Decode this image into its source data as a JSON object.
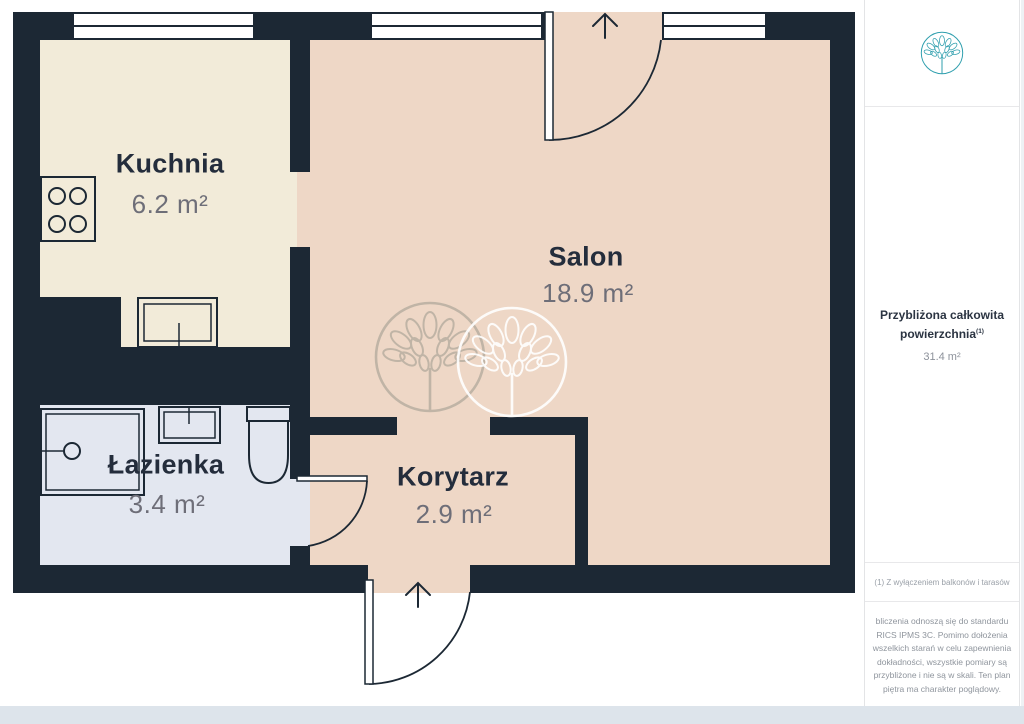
{
  "floorplan": {
    "wall_color": "#1c2834",
    "rooms": [
      {
        "id": "kuchnia",
        "name": "Kuchnia",
        "area": "6.2 m²",
        "floor_color": "#f2ebd9"
      },
      {
        "id": "salon",
        "name": "Salon",
        "area": "18.9 m²",
        "floor_color": "#eed7c6"
      },
      {
        "id": "lazienka",
        "name": "Łazienka",
        "area": "3.4 m²",
        "floor_color": "#e3e7f0"
      },
      {
        "id": "korytarz",
        "name": "Korytarz",
        "area": "2.9 m²",
        "floor_color": "#eed7c6"
      }
    ],
    "fixtures": [
      "stove",
      "kitchen-sink",
      "shower",
      "bathroom-sink",
      "toilet"
    ],
    "entrance_arrow": "up",
    "balcony_arrow": "up"
  },
  "watermark": {
    "gray": "#9b998c",
    "white": "#ffffff"
  },
  "sidebar": {
    "accent_color": "#2f9fae",
    "summary_title": "Przybliżona całkowita powierzchnia",
    "summary_marker": "(1)",
    "summary_value": "31.4 m²",
    "footnote": "(1) Z wyłączeniem balkonów i tarasów",
    "disclaimer": "bliczenia odnoszą się do standardu RICS IPMS 3C. Pomimo dołożenia wszelkich starań w celu zapewnienia dokładności, wszystkie pomiary są przybliżone i nie są w skali. Ten plan piętra ma charakter poglądowy.",
    "brand": {
      "name": "GIRAFFE",
      "suffix": "360"
    }
  }
}
